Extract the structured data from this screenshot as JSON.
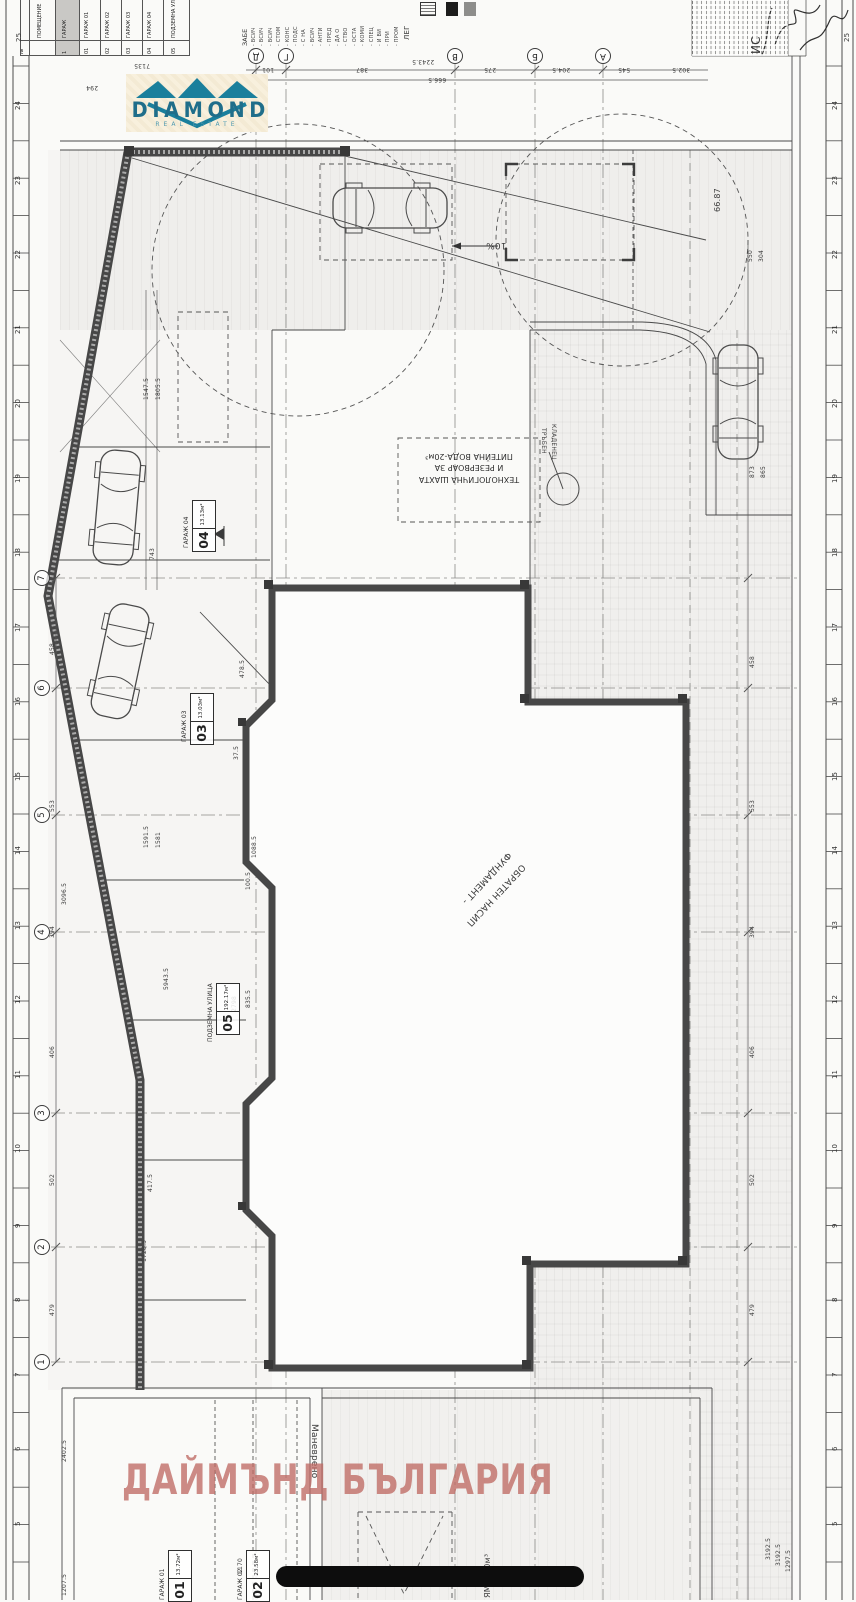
{
  "watermark": {
    "text": "ДАЙМЪНД БЪЛГАРИЯ",
    "color": "#bf6a64"
  },
  "logo": {
    "brand": "DIAMOND",
    "tagline": "REAL ESTATE",
    "accent": "#1a7f9c"
  },
  "legend_table": {
    "cols": [
      {
        "label": "",
        "num": "№"
      },
      {
        "label": "ПОМЕЩЕНИЕ",
        "num": ""
      },
      {
        "label": "ГАРАЖ",
        "num": "1",
        "shaded": true
      },
      {
        "label": "ГАРАЖ 01",
        "num": "01"
      },
      {
        "label": "ГАРАЖ 02",
        "num": "02"
      },
      {
        "label": "ГАРАЖ 03",
        "num": "03"
      },
      {
        "label": "ГАРАЖ 04",
        "num": "04"
      },
      {
        "label": "ПОДЗЕМНА УЛИЦА",
        "num": "05"
      }
    ]
  },
  "notes": {
    "title": "ЗАБЕ",
    "legend_label": "ЛЕГ",
    "lines": [
      "- ВСИЧ",
      "- ВСИЧ",
      "- ВСИЧ",
      "- СТОМ",
      "- КОНС",
      "- ПОДС",
      "- С НА",
      "- ВСИЧ",
      "- АНТИ",
      "- ПРЕД",
      "- ДА О",
      "- СТВО",
      "- ОСТА",
      "- КОМИ",
      "- СПЕЦ",
      "- И ВИ",
      "- ПРИ",
      "- ПРОМ"
    ]
  },
  "axes": {
    "letters": [
      {
        "t": "Д",
        "x": 248,
        "y": 48
      },
      {
        "t": "Г",
        "x": 278,
        "y": 48
      },
      {
        "t": "В",
        "x": 447,
        "y": 48
      },
      {
        "t": "Б",
        "x": 527,
        "y": 48
      },
      {
        "t": "А",
        "x": 595,
        "y": 48
      }
    ],
    "numbers": [
      {
        "t": "7",
        "x": 34,
        "y": 570
      },
      {
        "t": "6",
        "x": 34,
        "y": 680
      },
      {
        "t": "5",
        "x": 34,
        "y": 807
      },
      {
        "t": "4",
        "x": 34,
        "y": 924
      },
      {
        "t": "3",
        "x": 34,
        "y": 1105
      },
      {
        "t": "2",
        "x": 34,
        "y": 1239
      },
      {
        "t": "1",
        "x": 34,
        "y": 1354
      }
    ]
  },
  "rulers": {
    "left": [
      "24",
      "23",
      "22",
      "21",
      "20",
      "19",
      "18",
      "17",
      "16",
      "15",
      "14",
      "13",
      "12",
      "11",
      "10",
      "9",
      "8",
      "7",
      "6",
      "5"
    ],
    "right": [
      "24",
      "23",
      "22",
      "21",
      "20",
      "19",
      "18",
      "17",
      "16",
      "15",
      "14",
      "13",
      "12",
      "11",
      "10",
      "9",
      "8",
      "7",
      "6",
      "5"
    ]
  },
  "dims": {
    "top": [
      {
        "t": "7135",
        "x": 134,
        "y": 62
      },
      {
        "t": "294",
        "x": 86,
        "y": 84
      },
      {
        "t": "2243.5",
        "x": 412,
        "y": 58
      },
      {
        "t": "101",
        "x": 262,
        "y": 66
      },
      {
        "t": "387",
        "x": 356,
        "y": 66
      },
      {
        "t": "275",
        "x": 484,
        "y": 66
      },
      {
        "t": "204.5",
        "x": 552,
        "y": 66
      },
      {
        "t": "545",
        "x": 618,
        "y": 66
      },
      {
        "t": "302.5",
        "x": 672,
        "y": 66
      },
      {
        "t": "666.5",
        "x": 428,
        "y": 76
      }
    ],
    "left": [
      {
        "t": "458",
        "x": 50,
        "y": 655
      },
      {
        "t": "553",
        "x": 50,
        "y": 812
      },
      {
        "t": "394",
        "x": 50,
        "y": 938
      },
      {
        "t": "406",
        "x": 50,
        "y": 1058
      },
      {
        "t": "502",
        "x": 50,
        "y": 1186
      },
      {
        "t": "479",
        "x": 50,
        "y": 1316
      },
      {
        "t": "3096.5",
        "x": 62,
        "y": 905
      },
      {
        "t": "2402.5",
        "x": 62,
        "y": 1462
      },
      {
        "t": "1207.5",
        "x": 62,
        "y": 1596
      }
    ],
    "right": [
      {
        "t": "550",
        "x": 748,
        "y": 262
      },
      {
        "t": "304",
        "x": 759,
        "y": 262
      },
      {
        "t": "873",
        "x": 750,
        "y": 478
      },
      {
        "t": "865",
        "x": 761,
        "y": 478
      },
      {
        "t": "458",
        "x": 750,
        "y": 668
      },
      {
        "t": "553",
        "x": 750,
        "y": 812
      },
      {
        "t": "394",
        "x": 750,
        "y": 938
      },
      {
        "t": "406",
        "x": 750,
        "y": 1058
      },
      {
        "t": "502",
        "x": 750,
        "y": 1186
      },
      {
        "t": "479",
        "x": 750,
        "y": 1316
      },
      {
        "t": "3192.5",
        "x": 766,
        "y": 1560
      },
      {
        "t": "3192.5",
        "x": 776,
        "y": 1566
      },
      {
        "t": "1297.5",
        "x": 786,
        "y": 1572
      }
    ],
    "inner": [
      {
        "t": "1547.5",
        "x": 144,
        "y": 400
      },
      {
        "t": "1805.5",
        "x": 156,
        "y": 400
      },
      {
        "t": "743",
        "x": 150,
        "y": 560
      },
      {
        "t": "478.5",
        "x": 240,
        "y": 678
      },
      {
        "t": "37.5",
        "x": 234,
        "y": 760
      },
      {
        "t": "1591.5",
        "x": 144,
        "y": 848
      },
      {
        "t": "1581",
        "x": 156,
        "y": 848
      },
      {
        "t": "1088.5",
        "x": 252,
        "y": 858
      },
      {
        "t": "100.5",
        "x": 246,
        "y": 890
      },
      {
        "t": "5943.5",
        "x": 164,
        "y": 990
      },
      {
        "t": "2798",
        "x": 232,
        "y": 1012
      },
      {
        "t": "835.5",
        "x": 246,
        "y": 1008
      },
      {
        "t": "417.5",
        "x": 148,
        "y": 1192
      },
      {
        "t": "1728.5",
        "x": 142,
        "y": 1262
      },
      {
        "t": "1170",
        "x": 238,
        "y": 1574
      }
    ]
  },
  "rooms": [
    {
      "name": "ГАРАЖ 04",
      "num": "04",
      "area": "13.13м²",
      "nx": 184,
      "ny": 548,
      "bx": 192,
      "by": 552
    },
    {
      "name": "ГАРАЖ 03",
      "num": "03",
      "area": "13.03м²",
      "nx": 182,
      "ny": 742,
      "bx": 190,
      "by": 745
    },
    {
      "name": "ПОДЗЕМНА УЛИЦА",
      "num": "05",
      "area": "192.17м²",
      "nx": 208,
      "ny": 1042,
      "bx": 216,
      "by": 1035
    },
    {
      "name": "ГАРАЖ 01",
      "num": "01",
      "area": "13.72м²",
      "nx": 160,
      "ny": 1600,
      "bx": 168,
      "by": 1602
    },
    {
      "name": "ГАРАЖ 02",
      "num": "02",
      "area": "23.58м²",
      "nx": 238,
      "ny": 1600,
      "bx": 246,
      "by": 1602
    }
  ],
  "annotations": {
    "shaft": [
      "ТЕХНОЛОГИЧНА ШАХТА",
      "И РЕЗЕРВОАР ЗА",
      "ПИТЕЙНА ВОДА-20м³"
    ],
    "misc": [
      {
        "t": "10%",
        "x": 486,
        "y": 240,
        "r": 180,
        "fs": 9
      },
      {
        "t": "66.87",
        "x": 714,
        "y": 212,
        "r": -90,
        "fs": 8
      },
      {
        "t": "Маневрено",
        "x": 318,
        "y": 1424,
        "r": 90,
        "fs": 9
      },
      {
        "t": "ЯМА 2.0м³",
        "x": 484,
        "y": 1598,
        "r": -90,
        "fs": 8
      },
      {
        "t": "25",
        "x": 844,
        "y": 42,
        "r": -90,
        "fs": 7
      },
      {
        "t": "25",
        "x": 16,
        "y": 42,
        "r": -90,
        "fs": 7
      },
      {
        "t": "ИС",
        "x": 750,
        "y": 54,
        "r": -90,
        "fs": 12
      },
      {
        "t": "ТРЪБЕН",
        "x": 546,
        "y": 428,
        "r": 90,
        "fs": 6
      },
      {
        "t": "КЛАДЕНЕЦ",
        "x": 556,
        "y": 424,
        "r": 90,
        "fs": 6
      },
      {
        "t": "ФУНДАМЕНТ -",
        "x": 512,
        "y": 856,
        "r": 133,
        "fs": 9
      },
      {
        "t": "ОБРАТЕН НАСИП",
        "x": 526,
        "y": 868,
        "r": 133,
        "fs": 9
      },
      {
        "t": "ЛЕГ",
        "x": 404,
        "y": 40,
        "r": -90,
        "fs": 7
      }
    ]
  }
}
